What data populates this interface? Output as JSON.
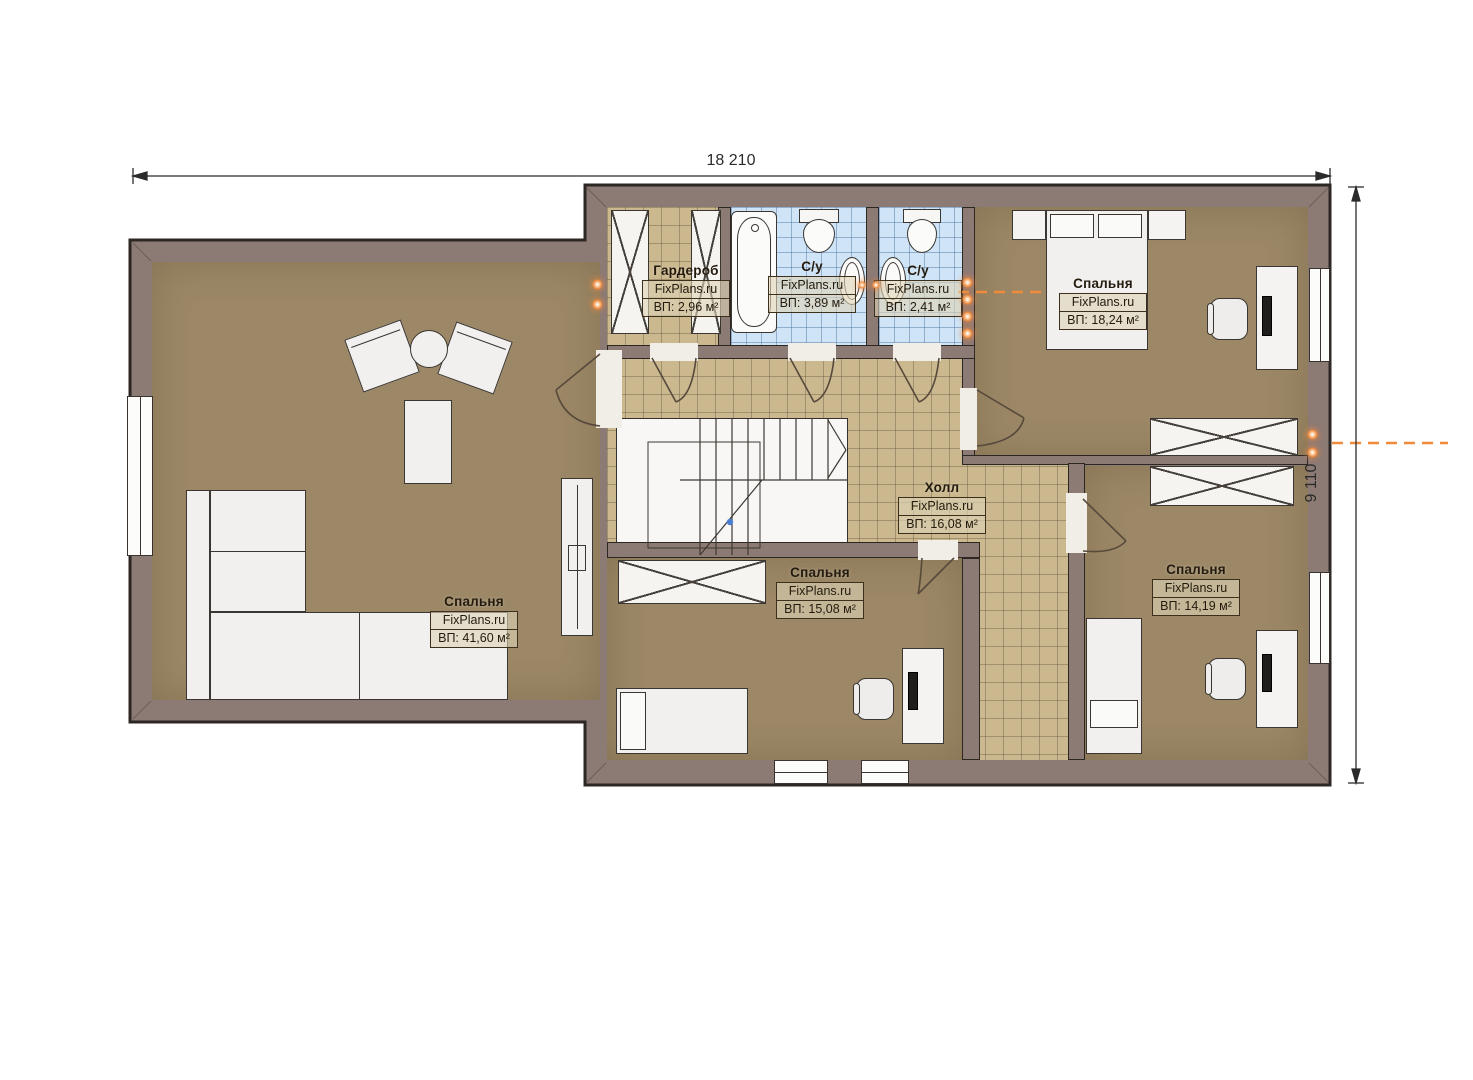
{
  "dimensions": {
    "width": "18 210",
    "height": "9 110"
  },
  "watermark": "FixPlans.ru",
  "rooms": {
    "wardrobe": {
      "name": "Гардероб",
      "area": "ВП: 2,96 м²"
    },
    "bath1": {
      "name": "С/у",
      "area": "ВП: 3,89 м²"
    },
    "bath2": {
      "name": "С/у",
      "area": "ВП: 2,41 м²"
    },
    "bedroom_top": {
      "name": "Спальня",
      "area": "ВП: 18,24 м²"
    },
    "hall": {
      "name": "Холл",
      "area": "ВП: 16,08 м²"
    },
    "bedroom_left": {
      "name": "Спальня",
      "area": "ВП: 41,60 м²"
    },
    "bedroom_mid": {
      "name": "Спальня",
      "area": "ВП: 15,08 м²"
    },
    "bedroom_right": {
      "name": "Спальня",
      "area": "ВП: 14,19 м²"
    }
  },
  "colors": {
    "wall": "#8c7a75",
    "wall_outline": "#2d2724",
    "wood_floor": "#9c8866",
    "tile_floor": "#cbb88e",
    "bath_floor": "#cfe4f6",
    "sconce": "#ed8a3f",
    "label_border": "#3c2f1c"
  }
}
